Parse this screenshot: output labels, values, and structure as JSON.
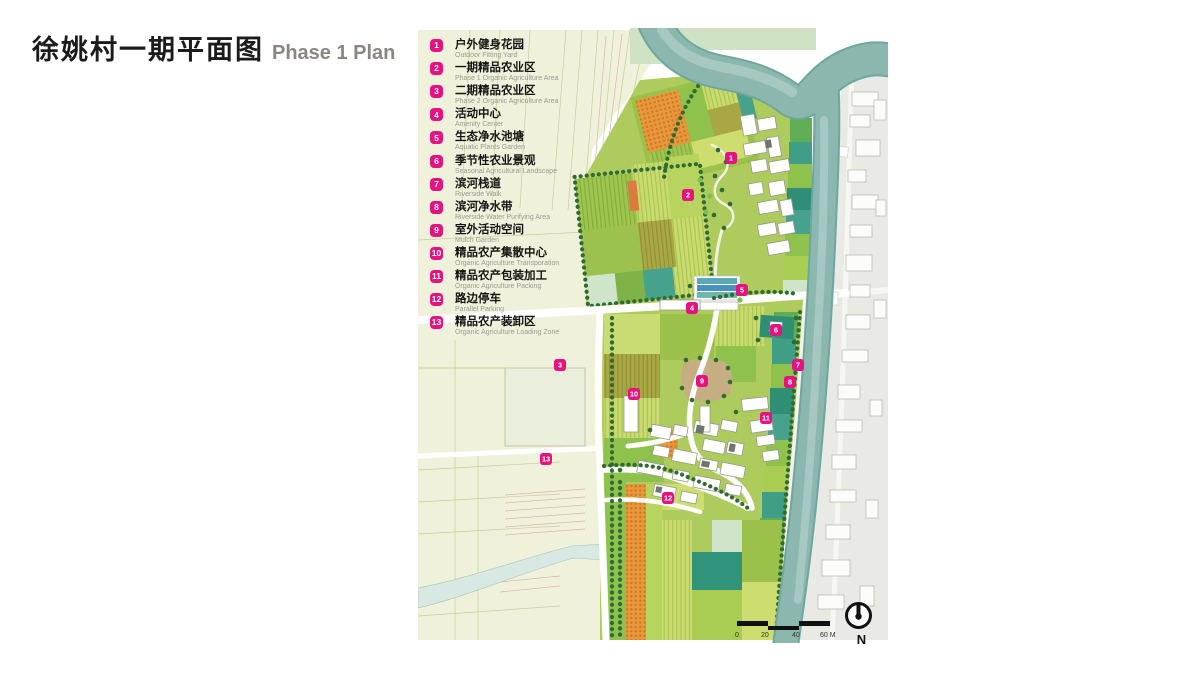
{
  "title": {
    "zh": "徐姚村一期平面图",
    "en": "Phase 1 Plan"
  },
  "legend": {
    "items": [
      {
        "num": "1",
        "zh": "户外健身花园",
        "en": "Outdoor Fitting Yard"
      },
      {
        "num": "2",
        "zh": "一期精品农业区",
        "en": "Phase 1 Organic Agriculture Area"
      },
      {
        "num": "3",
        "zh": "二期精品农业区",
        "en": "Phase 2 Organic Agriculture Area"
      },
      {
        "num": "4",
        "zh": "活动中心",
        "en": "Amenity Center"
      },
      {
        "num": "5",
        "zh": "生态净水池塘",
        "en": "Aquatic Plants Garden"
      },
      {
        "num": "6",
        "zh": "季节性农业景观",
        "en": "Seasonal Agricultural Landscape"
      },
      {
        "num": "7",
        "zh": "滨河栈道",
        "en": "Riverside Walk"
      },
      {
        "num": "8",
        "zh": "滨河净水带",
        "en": "Riverside Water Purifying Area"
      },
      {
        "num": "9",
        "zh": "室外活动空间",
        "en": "Mulch Garden"
      },
      {
        "num": "10",
        "zh": "精品农产集散中心",
        "en": "Organic Agriculture Transporation"
      },
      {
        "num": "11",
        "zh": "精品农产包装加工",
        "en": "Organic Agriculture Packing"
      },
      {
        "num": "12",
        "zh": "路边停车",
        "en": "Parallel Parking"
      },
      {
        "num": "13",
        "zh": "精品农产装卸区",
        "en": "Organic Agriculture Loading Zone"
      }
    ]
  },
  "map": {
    "markers": [
      {
        "num": "1",
        "x": 731,
        "y": 158
      },
      {
        "num": "2",
        "x": 688,
        "y": 195
      },
      {
        "num": "3",
        "x": 560,
        "y": 365
      },
      {
        "num": "4",
        "x": 692,
        "y": 308
      },
      {
        "num": "5",
        "x": 742,
        "y": 290
      },
      {
        "num": "6",
        "x": 776,
        "y": 330
      },
      {
        "num": "7",
        "x": 798,
        "y": 365
      },
      {
        "num": "8",
        "x": 790,
        "y": 382
      },
      {
        "num": "9",
        "x": 702,
        "y": 381
      },
      {
        "num": "10",
        "x": 634,
        "y": 394
      },
      {
        "num": "11",
        "x": 766,
        "y": 418
      },
      {
        "num": "12",
        "x": 668,
        "y": 498
      },
      {
        "num": "13",
        "x": 546,
        "y": 459
      }
    ],
    "scale_bar": {
      "labels": [
        "0",
        "20",
        "40",
        "60 M"
      ]
    },
    "north_label": "N"
  },
  "colors": {
    "accent": "#e5127f",
    "river": "#8cb7ae",
    "village_bg": "#e9e9e5",
    "pale_field": "#f0f1da",
    "tree_green": "#2f6b33"
  }
}
